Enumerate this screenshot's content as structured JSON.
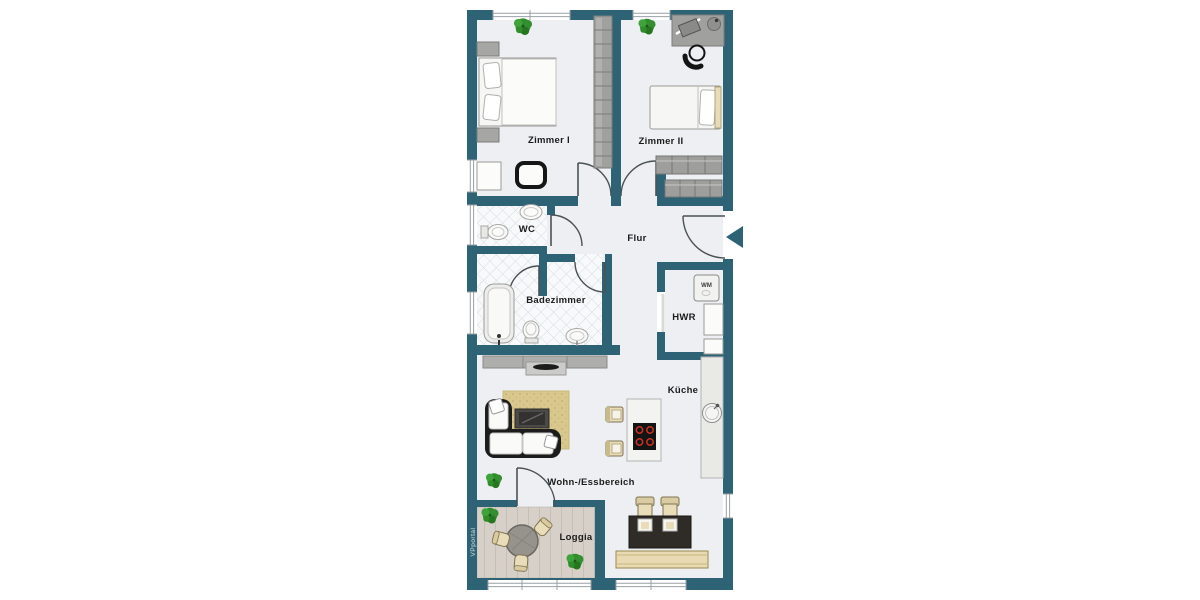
{
  "watermark": "VPportal",
  "rooms": {
    "zimmer1": {
      "label": "Zimmer I"
    },
    "zimmer2": {
      "label": "Zimmer II"
    },
    "wc": {
      "label": "WC"
    },
    "flur": {
      "label": "Flur"
    },
    "badezimmer": {
      "label": "Badezimmer"
    },
    "hwr": {
      "label": "HWR"
    },
    "kueche": {
      "label": "Küche"
    },
    "wohn_essbereich": {
      "label": "Wohn-/Essbereich"
    },
    "loggia": {
      "label": "Loggia"
    }
  },
  "appliances": {
    "washing_machine_label": "WM"
  },
  "colors": {
    "wall": "#2d6375",
    "floor": "#edeff2",
    "tile": "#f8f9fa",
    "rug": "#d9c88e",
    "entrance_arrow": "#2d6375"
  }
}
